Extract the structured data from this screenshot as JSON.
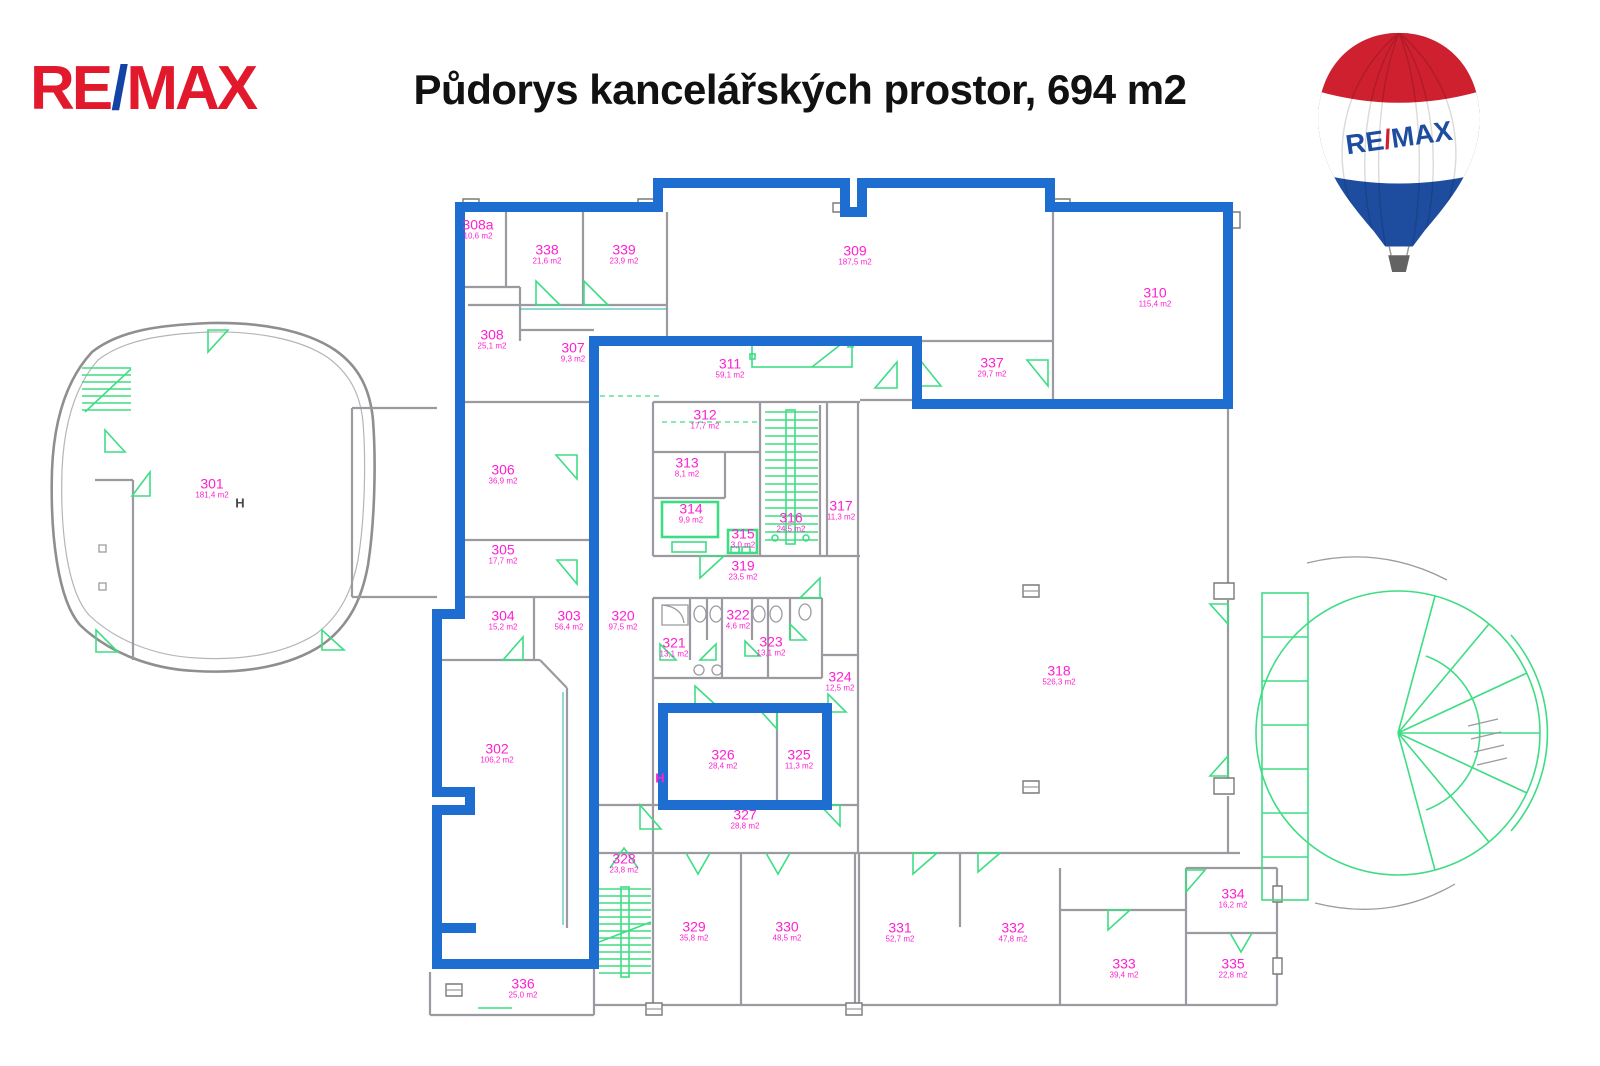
{
  "header": {
    "wordmark": {
      "re": "RE",
      "slash": "/",
      "max": "MAX"
    },
    "title": "Půdorys kancelářských prostor, 694 m2"
  },
  "balloon": {
    "re": "RE",
    "slash": "/",
    "max": "MAX"
  },
  "plan": {
    "rooms": [
      {
        "id": "301",
        "area": "181,4 m2",
        "x": 212,
        "y": 488
      },
      {
        "id": "302",
        "area": "106,2 m2",
        "x": 497,
        "y": 753
      },
      {
        "id": "303",
        "area": "56,4 m2",
        "x": 569,
        "y": 620
      },
      {
        "id": "304",
        "area": "15,2 m2",
        "x": 503,
        "y": 620
      },
      {
        "id": "305",
        "area": "17,7 m2",
        "x": 503,
        "y": 554
      },
      {
        "id": "306",
        "area": "36,9 m2",
        "x": 503,
        "y": 474
      },
      {
        "id": "307",
        "area": "9,3 m2",
        "x": 573,
        "y": 352
      },
      {
        "id": "308",
        "area": "25,1 m2",
        "x": 492,
        "y": 339
      },
      {
        "id": "308a",
        "area": "10,6 m2",
        "x": 478,
        "y": 229
      },
      {
        "id": "309",
        "area": "187,5 m2",
        "x": 855,
        "y": 255
      },
      {
        "id": "310",
        "area": "115,4 m2",
        "x": 1155,
        "y": 297
      },
      {
        "id": "311",
        "area": "59,1 m2",
        "x": 730,
        "y": 368
      },
      {
        "id": "312",
        "area": "17,7 m2",
        "x": 705,
        "y": 419
      },
      {
        "id": "313",
        "area": "8,1 m2",
        "x": 687,
        "y": 467
      },
      {
        "id": "314",
        "area": "9,9 m2",
        "x": 691,
        "y": 513
      },
      {
        "id": "315",
        "area": "3,0 m2",
        "x": 743,
        "y": 538
      },
      {
        "id": "316",
        "area": "24,5 m2",
        "x": 791,
        "y": 522
      },
      {
        "id": "317",
        "area": "11,3 m2",
        "x": 841,
        "y": 510
      },
      {
        "id": "318",
        "area": "526,3 m2",
        "x": 1059,
        "y": 675
      },
      {
        "id": "319",
        "area": "23,5 m2",
        "x": 743,
        "y": 570
      },
      {
        "id": "320",
        "area": "97,5 m2",
        "x": 623,
        "y": 620
      },
      {
        "id": "321",
        "area": "13,1 m2",
        "x": 674,
        "y": 647
      },
      {
        "id": "322",
        "area": "4,6 m2",
        "x": 738,
        "y": 619
      },
      {
        "id": "323",
        "area": "13,1 m2",
        "x": 771,
        "y": 646
      },
      {
        "id": "324",
        "area": "12,5 m2",
        "x": 840,
        "y": 681
      },
      {
        "id": "325",
        "area": "11,3 m2",
        "x": 799,
        "y": 759
      },
      {
        "id": "326",
        "area": "28,4 m2",
        "x": 723,
        "y": 759
      },
      {
        "id": "327",
        "area": "28,8 m2",
        "x": 745,
        "y": 819
      },
      {
        "id": "328",
        "area": "23,8 m2",
        "x": 624,
        "y": 863
      },
      {
        "id": "329",
        "area": "35,8 m2",
        "x": 694,
        "y": 931
      },
      {
        "id": "330",
        "area": "48,5 m2",
        "x": 787,
        "y": 931
      },
      {
        "id": "331",
        "area": "52,7 m2",
        "x": 900,
        "y": 932
      },
      {
        "id": "332",
        "area": "47,8 m2",
        "x": 1013,
        "y": 932
      },
      {
        "id": "333",
        "area": "39,4 m2",
        "x": 1124,
        "y": 968
      },
      {
        "id": "334",
        "area": "16,2 m2",
        "x": 1233,
        "y": 898
      },
      {
        "id": "335",
        "area": "22,8 m2",
        "x": 1233,
        "y": 968
      },
      {
        "id": "336",
        "area": "25,0 m2",
        "x": 523,
        "y": 988
      },
      {
        "id": "337",
        "area": "29,7 m2",
        "x": 992,
        "y": 367
      },
      {
        "id": "338",
        "area": "21,6 m2",
        "x": 547,
        "y": 254
      },
      {
        "id": "339",
        "area": "23,9 m2",
        "x": 624,
        "y": 254
      }
    ],
    "markers": [
      {
        "text": "H",
        "style": "dark",
        "x": 240,
        "y": 503
      },
      {
        "text": "H",
        "style": "magenta",
        "x": 660,
        "y": 778
      }
    ]
  },
  "colors": {
    "outline_blue": "#1e6ed2",
    "label": "#ff20d0",
    "green": "#3edd84",
    "wall": "#9a9aa0",
    "brand_red": "#e2192c",
    "brand_blue": "#1243a5",
    "balloon_red": "#cf2030",
    "balloon_blue": "#1e4da0"
  }
}
